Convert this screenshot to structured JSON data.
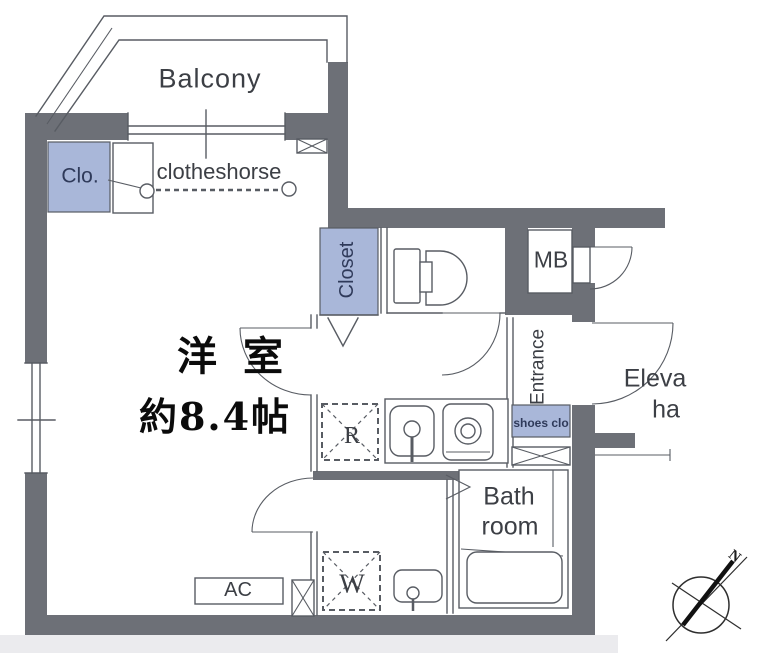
{
  "title": "apartment-floor-plan",
  "colors": {
    "wall": "#6d7077",
    "closet_blue": "#a9b7d9",
    "line": "#585c63",
    "label_text": "#3c3f45",
    "navy_text": "#2f3a5a"
  },
  "labels": {
    "balcony": "Balcony",
    "clo": "Clo.",
    "clotheshorse": "clotheshorse",
    "room_name": "洋室",
    "room_size": "約8.4帖",
    "closet": "Closet",
    "mb": "MB",
    "entrance": "Entrance",
    "shoes_closet": "shoes clo",
    "elevator_line1": "Eleva",
    "elevator_line2": "ha",
    "refrigerator": "R",
    "washer": "W",
    "bath_line1": "Bath",
    "bath_line2": "room",
    "ac": "AC",
    "compass_north": "N"
  }
}
